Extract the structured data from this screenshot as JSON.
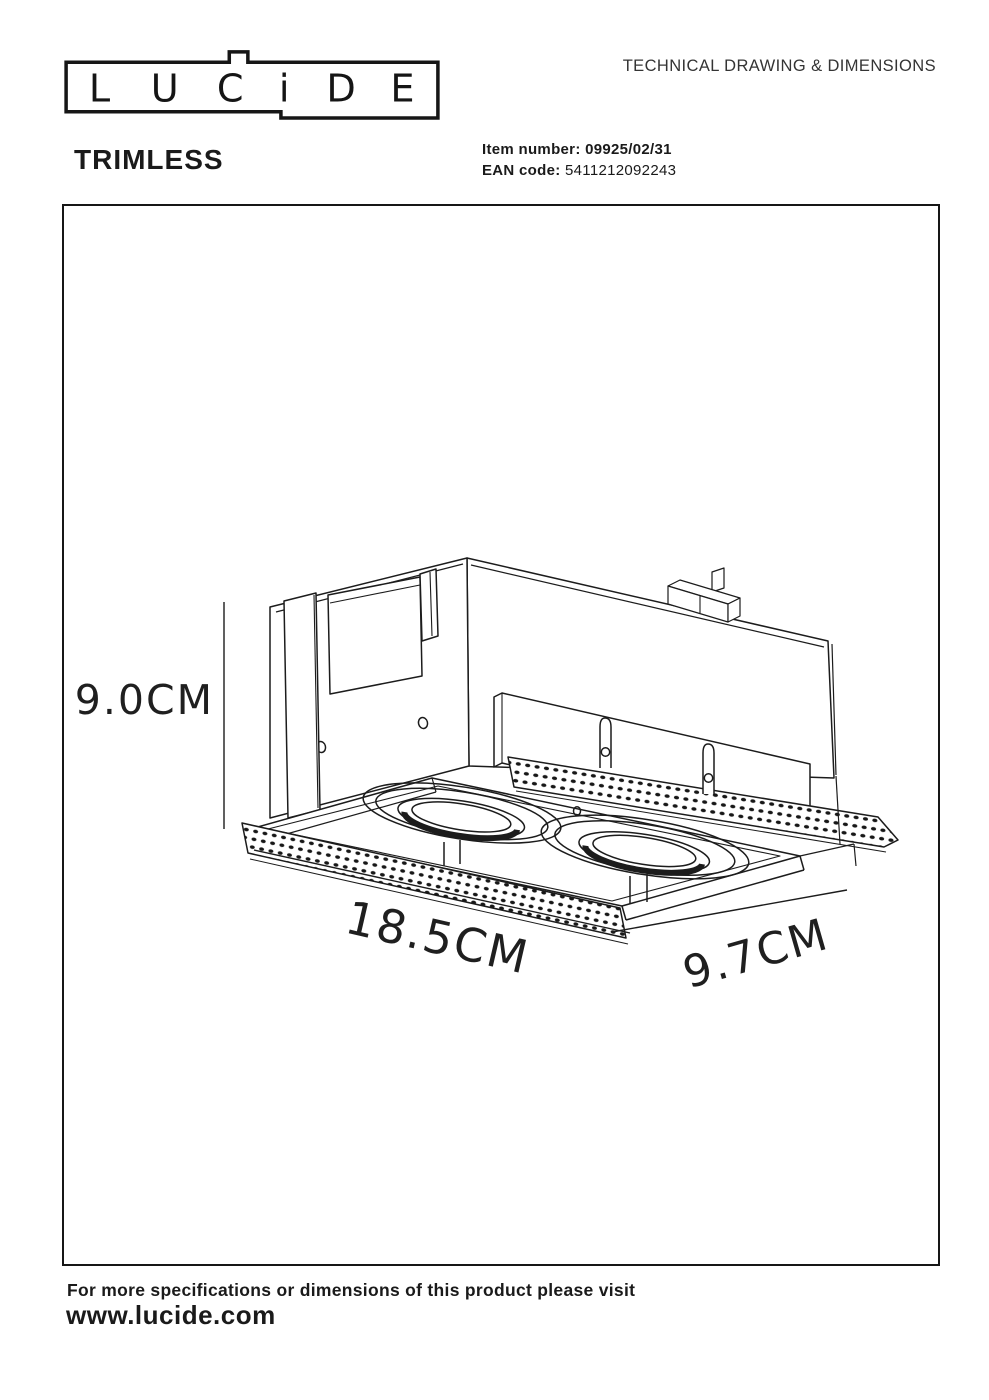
{
  "logo": {
    "letters": [
      "L",
      "U",
      "C",
      "i",
      "D",
      "E"
    ]
  },
  "header": {
    "title": "TECHNICAL DRAWING & DIMENSIONS"
  },
  "product": {
    "name": "TRIMLESS",
    "item_label": "Item number:",
    "item_value": "09925/02/31",
    "ean_label": "EAN code:",
    "ean_value": "5411212092243"
  },
  "drawing": {
    "dim_height": "9.0CM",
    "dim_length": "18.5CM",
    "dim_width": "9.7CM"
  },
  "footer": {
    "line1": "For more specifications or dimensions of this product please visit",
    "link": "www.lucide.com"
  }
}
